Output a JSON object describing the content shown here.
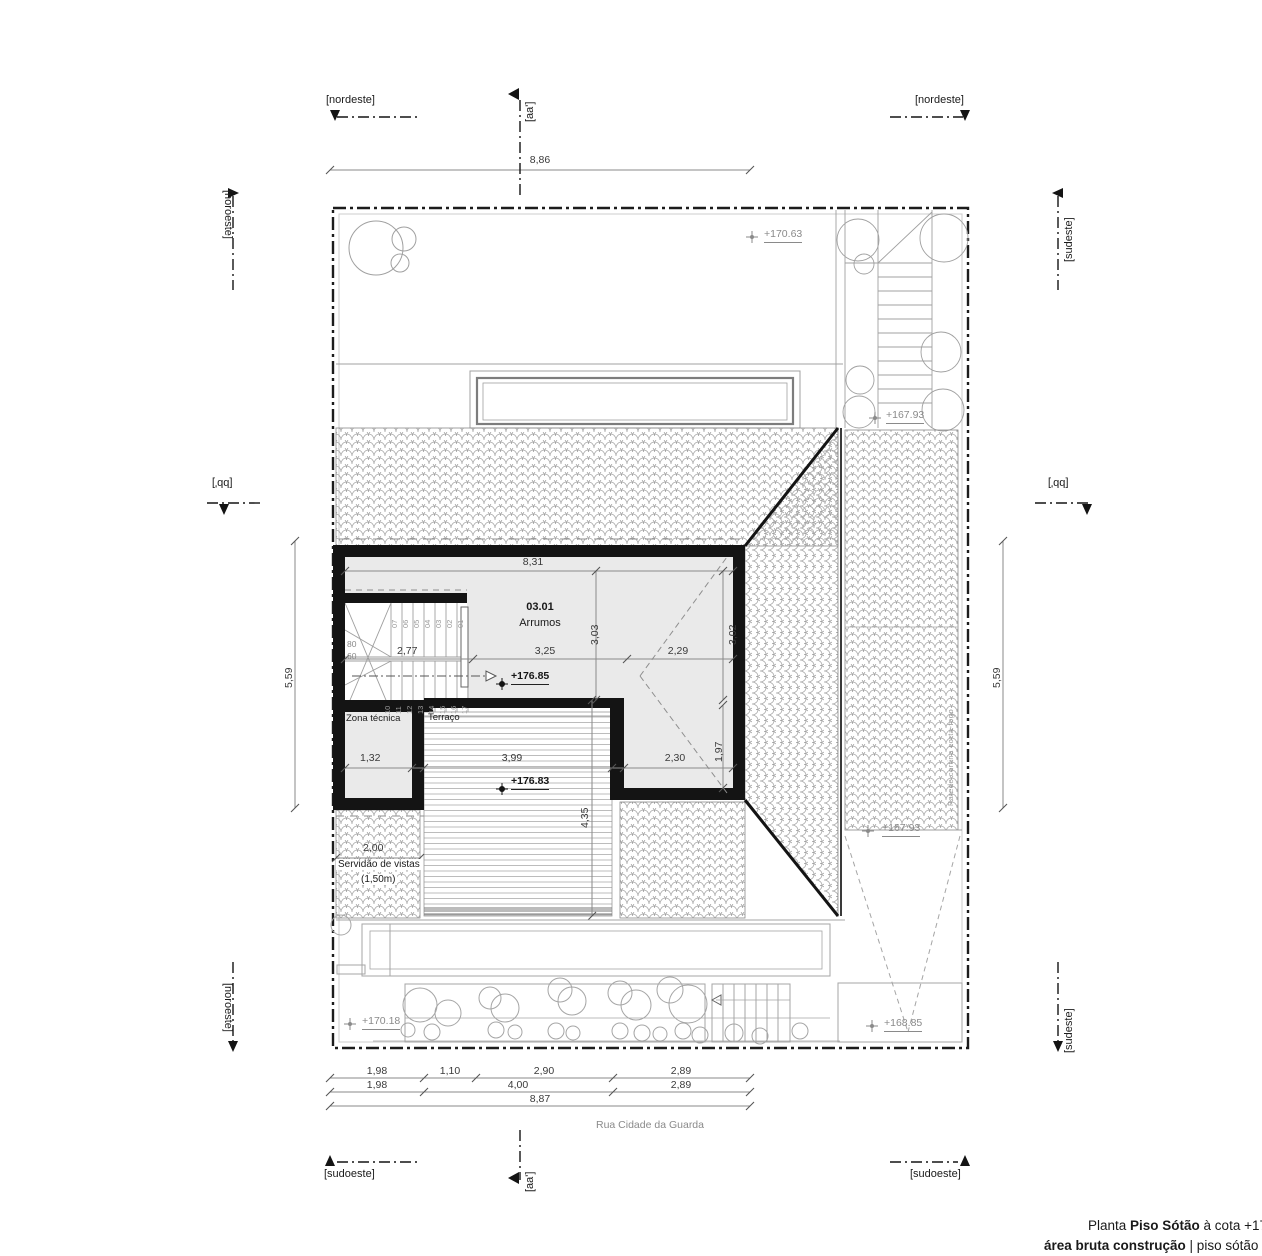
{
  "markers": {
    "nordeste_left": "[nordeste]",
    "nordeste_right": "[nordeste]",
    "noroeste_top": "[noroeste]",
    "noroeste_bottom": "[noroeste]",
    "sudeste_top": "[sudeste]",
    "sudeste_bottom": "[sudeste]",
    "sudoeste_left": "[sudoeste]",
    "sudoeste_right": "[sudoeste]",
    "section_aa_top": "[aa']",
    "section_aa_bottom": "[aa']",
    "section_bb_left": "[bb']",
    "section_bb_right": "[bb']"
  },
  "street_label": "Rua Cidade da Guarda",
  "rooms": {
    "arrumos_number": "03.01",
    "arrumos_name": "Arrumos",
    "zona_tecnica": "Zona técnica",
    "terraco": "Terraço",
    "servidao_line1": "Servidão de vistas",
    "servidao_line2": "(1,50m)"
  },
  "elevations": {
    "garden_top": "+170.63",
    "stair_top": "+167.93",
    "arrumos": "+176.85",
    "terraco": "+176.83",
    "roof_right": "+167.93",
    "garden_bottom": "+170.18",
    "driveway": "+168.85"
  },
  "dimensions": {
    "top_width": "8,86",
    "left_height": "5,59",
    "right_height": "5,59",
    "room_width": "8,31",
    "stair_run": "2,77",
    "room_left_span": "3,25",
    "room_right_span": "2,29",
    "room_depth_left": "3,03",
    "room_depth_right": "3,02",
    "zona_width": "1,32",
    "terraco_width": "3,99",
    "wing_width": "2,30",
    "wing_depth": "1,97",
    "terraco_depth": "4,35",
    "servidao_width": "2,00",
    "stair_riser_labels": [
      "80",
      "60"
    ],
    "steps_upper": [
      "07",
      "06",
      "05",
      "04",
      "03",
      "02",
      "01"
    ],
    "steps_lower": [
      "10",
      "11",
      "12",
      "13",
      "14",
      "15",
      "16",
      "17"
    ],
    "bottom_row1": [
      "1,98",
      "1,10",
      "2,90",
      "2,89"
    ],
    "bottom_row2": [
      "1,98",
      "4,00",
      "2,89"
    ],
    "bottom_total": "8,87"
  },
  "notes": {
    "wall_note": "Parede cortina corta-fogo"
  },
  "footer": {
    "l1a": "Planta ",
    "l1b": "Piso Sótão",
    "l1c": " à cota +17",
    "l2a": "área bruta construção",
    "l2b": " | piso sótão = 03"
  },
  "colors": {
    "wall": "#141414",
    "line_gray": "#9a9a9a",
    "annotation_gray": "#8a8a8a",
    "room_fill": "#eaeaea"
  }
}
